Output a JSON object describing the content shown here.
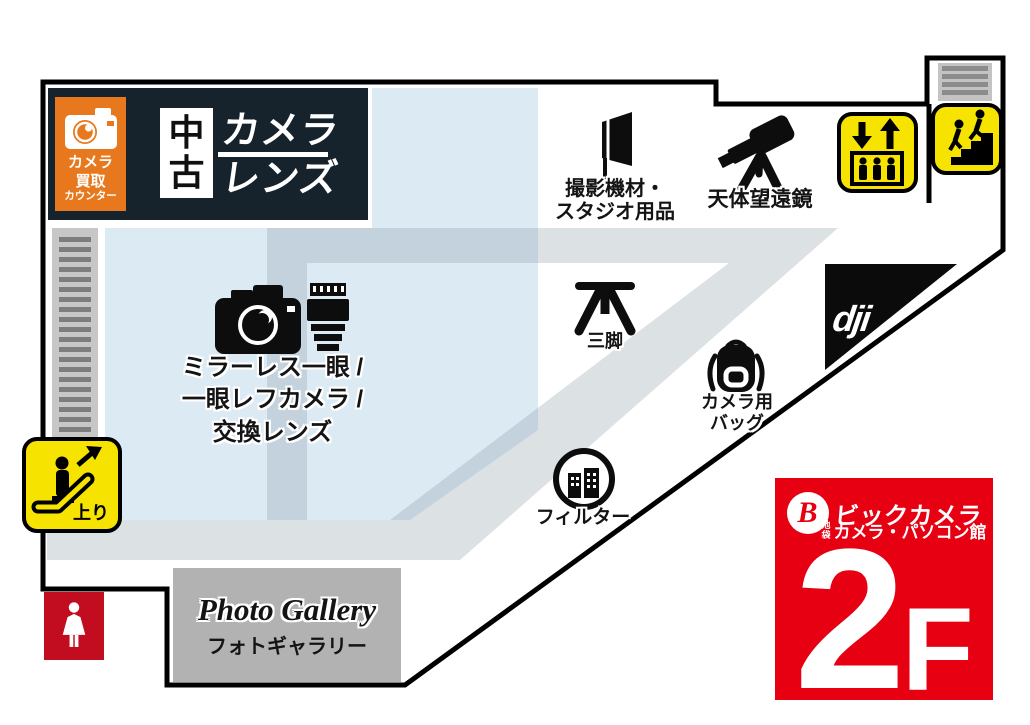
{
  "header": {
    "buy_counter": {
      "line1": "カメラ",
      "line2": "買取",
      "line3": "カウンター"
    },
    "used": {
      "char1": "中",
      "char2": "古",
      "word1": "カメラ",
      "word2": "レンズ"
    }
  },
  "areas": {
    "mirrorless": {
      "lines": [
        "ミラーレス一眼 /",
        "一眼レフカメラ /",
        "交換レンズ"
      ]
    },
    "studio": {
      "lines": [
        "撮影機材・",
        "スタジオ用品"
      ]
    },
    "telescope": {
      "label": "天体望遠鏡"
    },
    "tripod": {
      "label": "三脚"
    },
    "camera_bag": {
      "lines": [
        "カメラ用",
        "バッグ"
      ]
    },
    "filter": {
      "label": "フィルター"
    },
    "dji": {
      "label": "dji"
    },
    "photo_gallery": {
      "title": "Photo Gallery",
      "subtitle": "フォトギャラリー"
    }
  },
  "transport": {
    "escalator_up": {
      "label": "上り"
    }
  },
  "floor_badge": {
    "b_mark": "B",
    "brand": "ビックカメラ",
    "branch_small_1": "池",
    "branch_small_2": "袋",
    "branch": "カメラ・パソコン館",
    "floor_digit": "2",
    "floor_letter": "F"
  },
  "colors": {
    "navy": "#16222c",
    "orange": "#e8781e",
    "bic_red": "#e60012",
    "restroom_red": "#c20d20",
    "transport_yellow": "#f6e300",
    "sales_blue": "#dceaf4",
    "walkway_gray": "#e3e6e7",
    "gallery_gray": "#b2b2b2",
    "outline_black": "#000000"
  }
}
